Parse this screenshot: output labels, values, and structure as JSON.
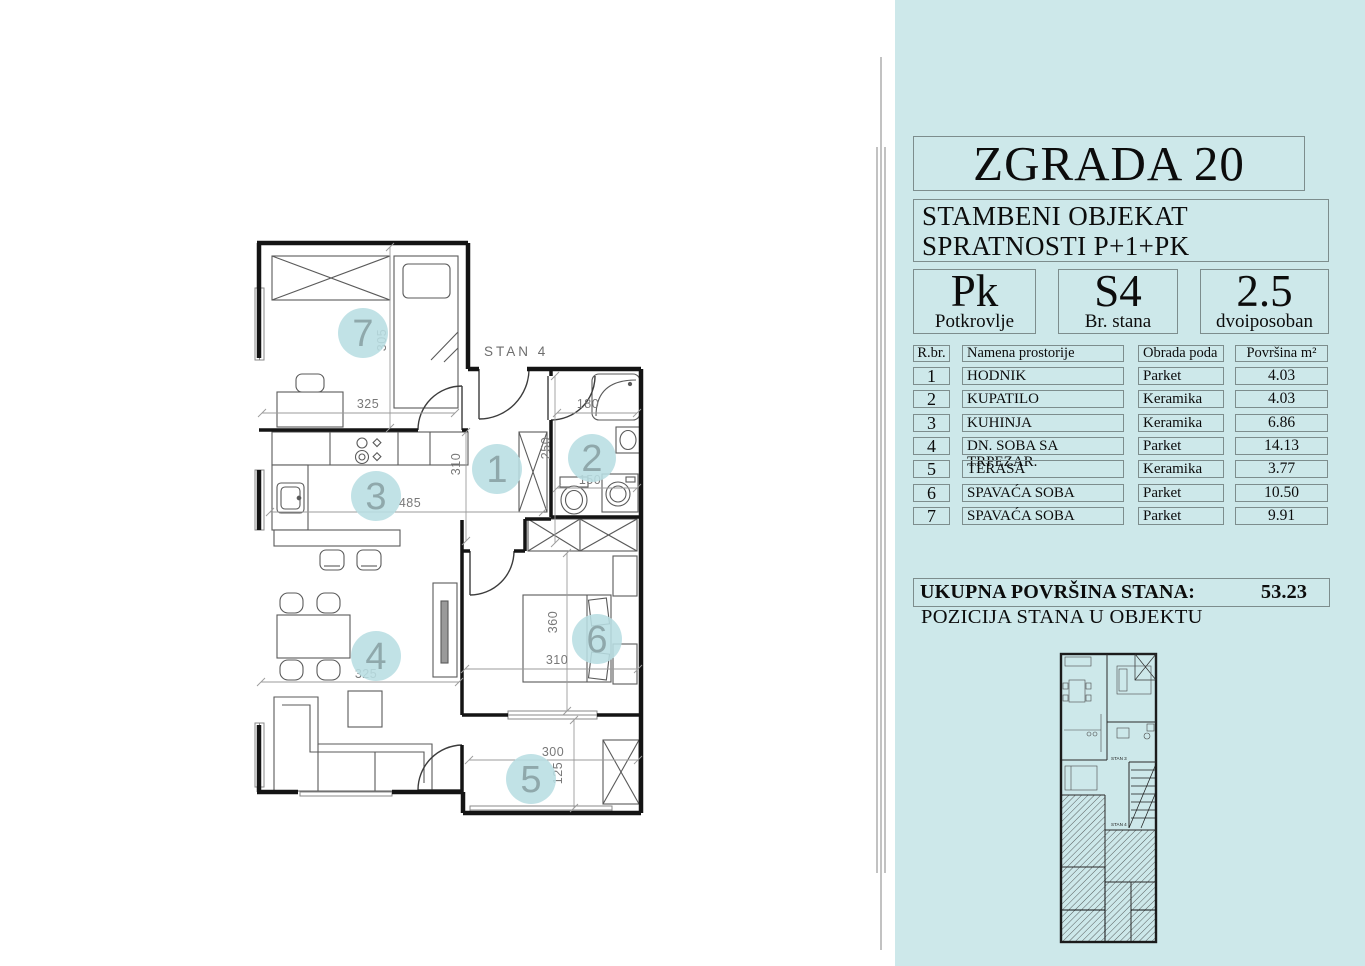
{
  "panel": {
    "building_title": "ZGRADA 20",
    "subtitle_line1": "STAMBENI OBJEKAT",
    "subtitle_line2": "SPRATNOSTI P+1+PK",
    "info_boxes": [
      {
        "value": "Pk",
        "label": "Potkrovlje"
      },
      {
        "value": "S4",
        "label": "Br. stana"
      },
      {
        "value": "2.5",
        "label": "dvoiposoban"
      }
    ],
    "table": {
      "headers": {
        "num": "R.br.",
        "name": "Namena prostorije",
        "floor": "Obrada poda",
        "area": "Površina  m²"
      },
      "rows": [
        {
          "num": "1",
          "name": "HODNIK",
          "floor": "Parket",
          "area": "4.03"
        },
        {
          "num": "2",
          "name": "KUPATILO",
          "floor": "Keramika",
          "area": "4.03"
        },
        {
          "num": "3",
          "name": "KUHINJA",
          "floor": "Keramika",
          "area": "6.86"
        },
        {
          "num": "4",
          "name": "DN. SOBA SA TRPEZAR.",
          "floor": "Parket",
          "area": "14.13"
        },
        {
          "num": "5",
          "name": "TERASA",
          "floor": "Keramika",
          "area": "3.77"
        },
        {
          "num": "6",
          "name": "SPAVAĆA SOBA",
          "floor": "Parket",
          "area": "10.50"
        },
        {
          "num": "7",
          "name": "SPAVAĆA SOBA",
          "floor": "Parket",
          "area": "9.91"
        }
      ]
    },
    "total": {
      "label": "UKUPNA POVRŠINA STANA:",
      "value": "53.23"
    },
    "position_title": "POZICIJA STANA  U OBJEKTU",
    "mini_plan_labels": {
      "upper": "STAN 3",
      "lower": "STAN 4"
    }
  },
  "plan": {
    "unit_label": "STAN 4",
    "rooms": [
      {
        "number": "1"
      },
      {
        "number": "2"
      },
      {
        "number": "3"
      },
      {
        "number": "4"
      },
      {
        "number": "5"
      },
      {
        "number": "6"
      },
      {
        "number": "7"
      }
    ],
    "dims": [
      {
        "text": "325"
      },
      {
        "text": "305"
      },
      {
        "text": "180"
      },
      {
        "text": "250"
      },
      {
        "text": "150"
      },
      {
        "text": "310"
      },
      {
        "text": "485"
      },
      {
        "text": "325"
      },
      {
        "text": "360"
      },
      {
        "text": "310"
      },
      {
        "text": "300"
      },
      {
        "text": "125"
      }
    ]
  },
  "colors": {
    "panel_bg": "#cde8ea",
    "room_marker": "#b8dee2",
    "wall": "#141414",
    "dimension_text": "#787878"
  }
}
